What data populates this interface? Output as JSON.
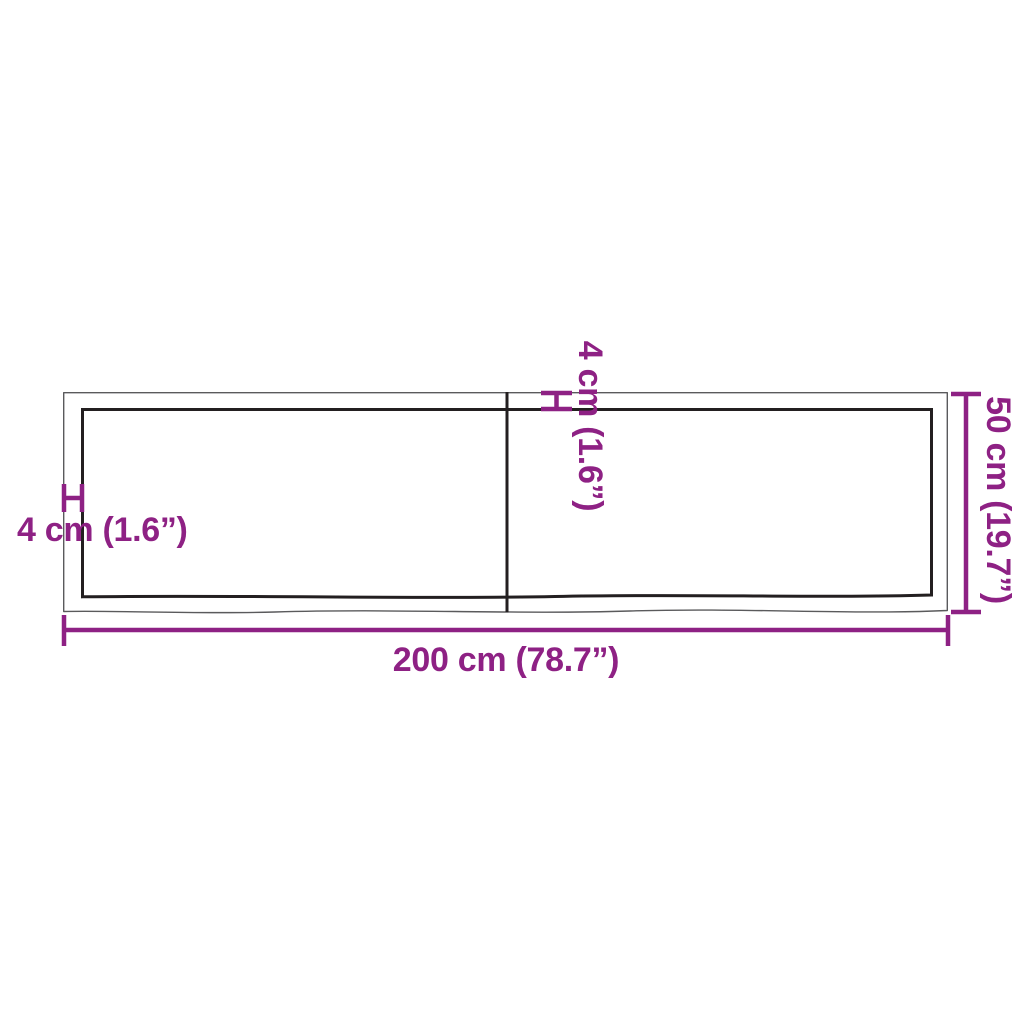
{
  "labels": {
    "width": "200 cm (78.7”)",
    "height": "50 cm (19.7”)",
    "thickness_left": "4 cm (1.6”)",
    "thickness_top": "4 cm (1.6”)"
  },
  "colors": {
    "dimension": "#8e2184",
    "board_line": "#231f20",
    "board_edge": "#5a5a5c",
    "background": "#ffffff"
  }
}
